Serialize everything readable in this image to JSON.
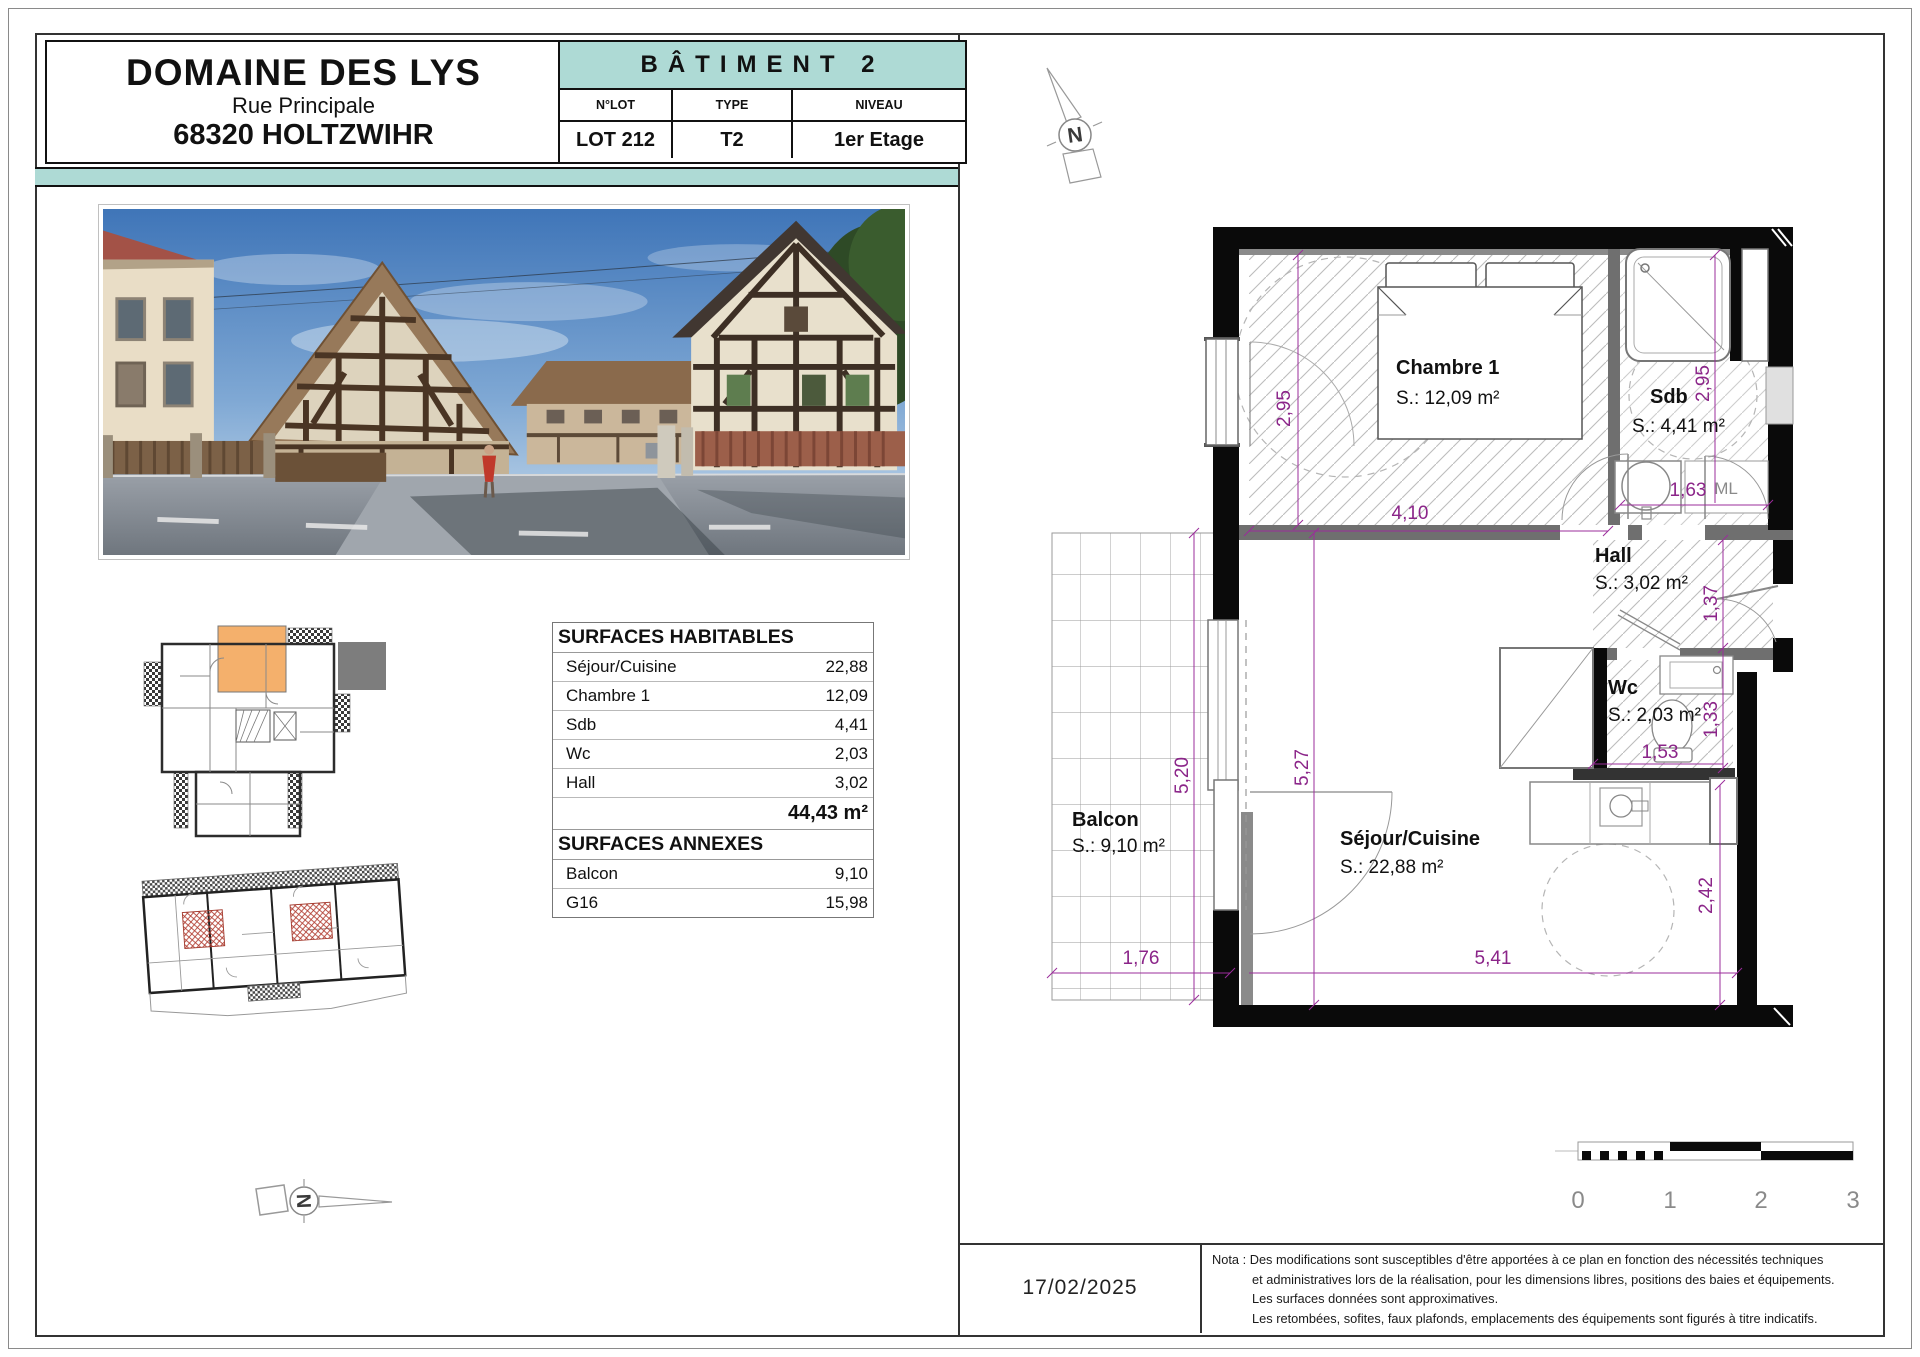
{
  "header": {
    "project_name": "DOMAINE DES LYS",
    "street": "Rue Principale",
    "city": "68320 HOLTZWIHR",
    "building_title": "BÂTIMENT 2",
    "lot_header": "N°LOT",
    "type_header": "TYPE",
    "level_header": "NIVEAU",
    "lot_value": "LOT 212",
    "type_value": "T2",
    "level_value": "1er Etage"
  },
  "surfaces": {
    "habitables_title": "SURFACES HABITABLES",
    "rows": [
      {
        "label": "Séjour/Cuisine",
        "value": "22,88"
      },
      {
        "label": "Chambre 1",
        "value": "12,09"
      },
      {
        "label": "Sdb",
        "value": "4,41"
      },
      {
        "label": "Wc",
        "value": "2,03"
      },
      {
        "label": "Hall",
        "value": "3,02"
      }
    ],
    "total": "44,43 m²",
    "annexes_title": "SURFACES ANNEXES",
    "annex_rows": [
      {
        "label": "Balcon",
        "value": "9,10"
      },
      {
        "label": "G16",
        "value": "15,98"
      }
    ]
  },
  "plan": {
    "rooms": {
      "chambre": {
        "name": "Chambre 1",
        "area": "S.: 12,09 m²"
      },
      "sdb": {
        "name": "Sdb",
        "area": "S.: 4,41 m²"
      },
      "hall": {
        "name": "Hall",
        "area": "S.: 3,02 m²"
      },
      "wc": {
        "name": "Wc",
        "area": "S.: 2,03 m²"
      },
      "sejour": {
        "name": "Séjour/Cuisine",
        "area": "S.: 22,88 m²"
      },
      "balcon": {
        "name": "Balcon",
        "area": "S.: 9,10 m²"
      }
    },
    "labels": {
      "ml": "ML",
      "north": "N"
    },
    "dims": {
      "chambre_height": "2,95",
      "chambre_width": "4,10",
      "sdb_height": "2,95",
      "sdb_width": "1,63",
      "hall_height": "1,37",
      "wc_height": "1,33",
      "wc_width": "1,53",
      "balcon_height": "5,20",
      "sejour_height": "5,27",
      "balcon_width": "1,76",
      "sejour_width": "5,41",
      "kitchen_height": "2,42"
    },
    "scale_ticks": [
      "0",
      "1",
      "2",
      "3"
    ]
  },
  "footer": {
    "date": "17/02/2025",
    "nota_line1": "Nota : Des modifications sont susceptibles d'être apportées à ce plan en fonction des nécessités techniques",
    "nota_line2": "et administratives lors de la réalisation, pour les dimensions libres, positions des baies et équipements.",
    "nota_line3": "Les surfaces données sont approximatives.",
    "nota_line4": "Les retombées, sofites, faux plafonds, emplacements des équipements sont figurés à titre indicatifs."
  },
  "colors": {
    "accent_teal": "#aedad5",
    "dimension_purple": "#8B2589",
    "highlight_orange": "#f4b06c"
  }
}
